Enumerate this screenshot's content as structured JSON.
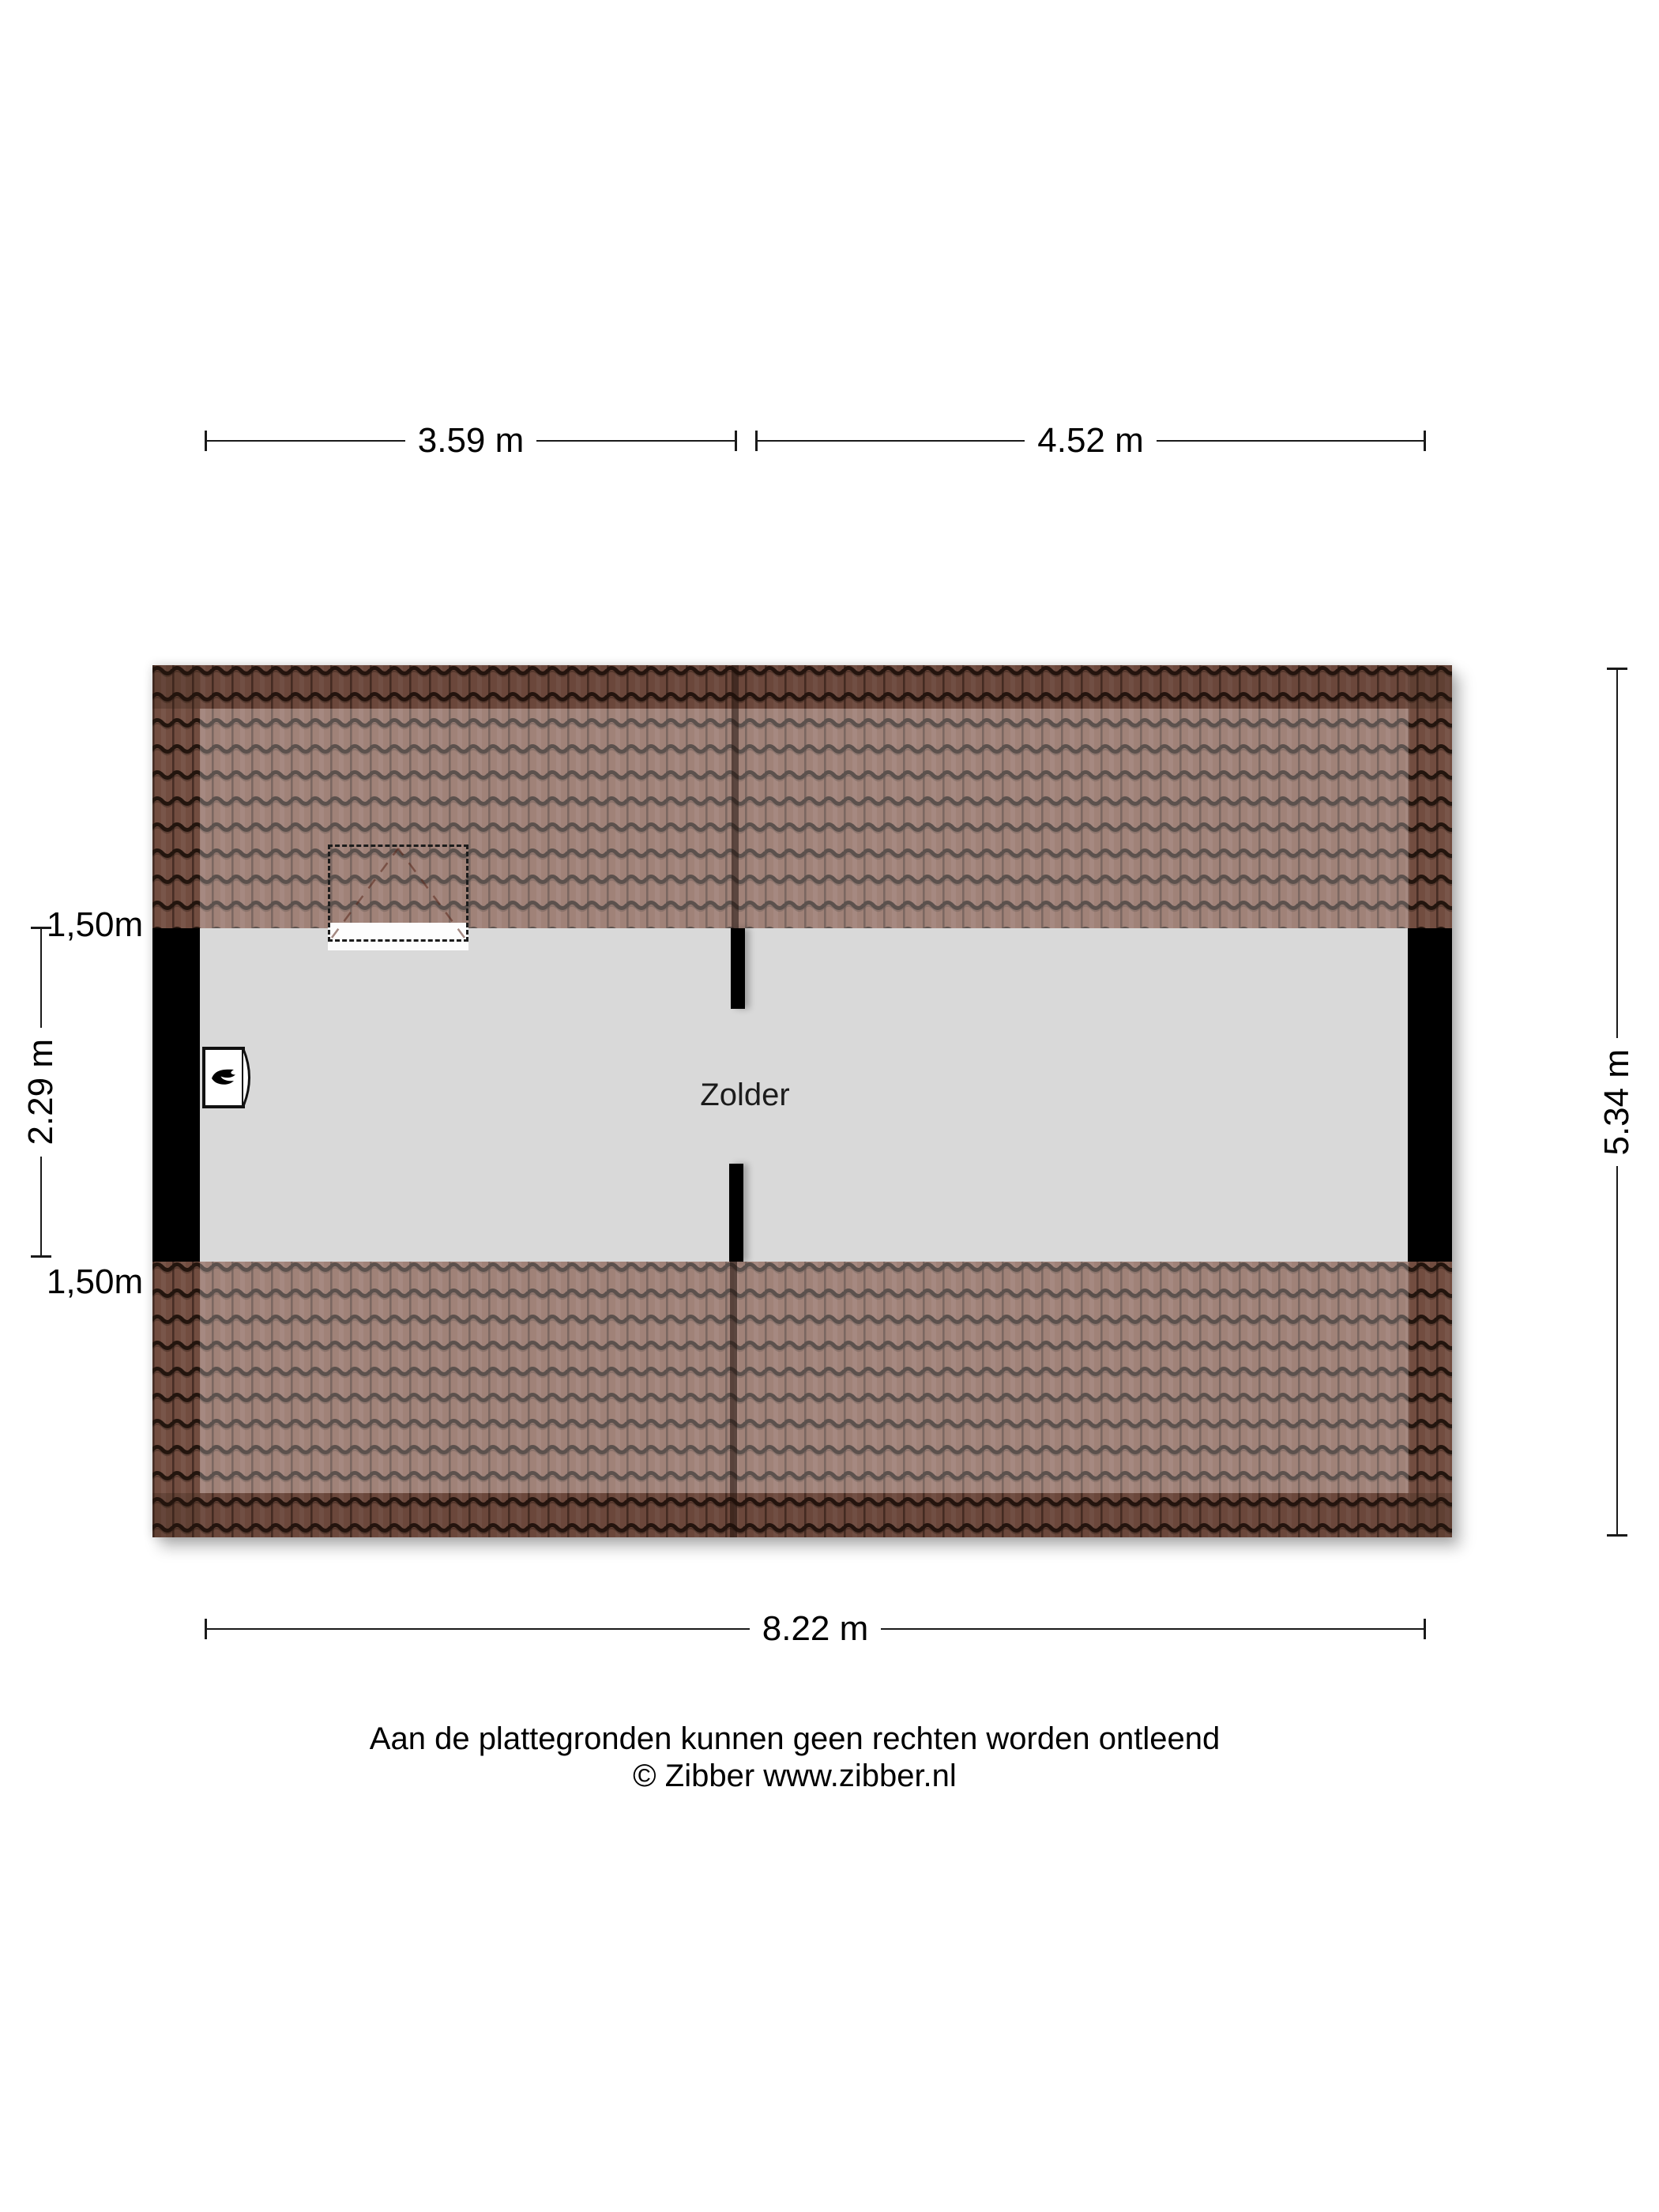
{
  "dims": {
    "top_left": "3.59 m",
    "top_right": "4.52 m",
    "right": "5.34 m",
    "bottom": "8.22 m",
    "left_upper": "1,50m",
    "left_mid": "2.29 m",
    "left_lower": "1,50m"
  },
  "room": {
    "label": "Zolder"
  },
  "objects": {
    "boiler_icon": "flame-icon",
    "roof_window": "dashed-roof-window"
  },
  "colors": {
    "floor": "#d9d9d9",
    "wall": "#000000",
    "tile_base": "#7f574a",
    "tile_seam": "#241510",
    "background": "#ffffff"
  },
  "footer": {
    "line1": "Aan de plattegronden kunnen geen rechten worden ontleend",
    "line2": "© Zibber www.zibber.nl"
  }
}
